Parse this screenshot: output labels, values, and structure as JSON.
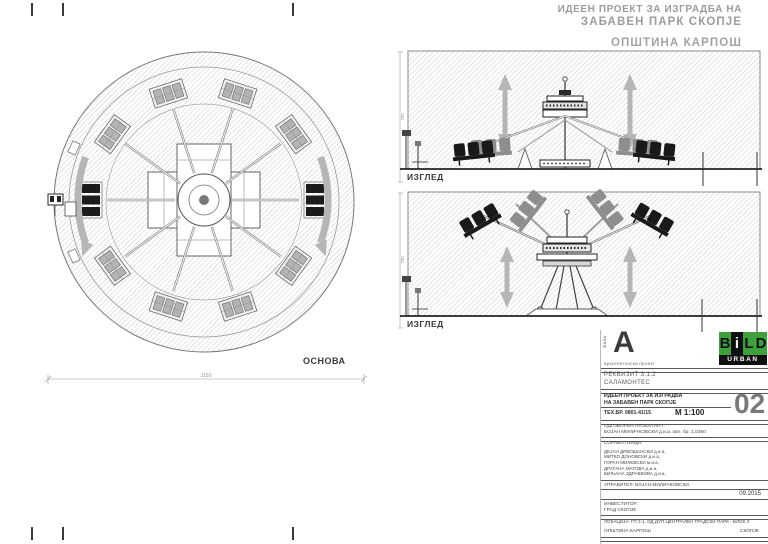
{
  "header": {
    "line1": "ИДЕЕН ПРОЕКТ ЗА ИЗГРАДБА НА",
    "line2": "ЗАБАВЕН ПАРК СКОПЈЕ",
    "line3": "ОПШТИНА КАРПОШ"
  },
  "plan": {
    "label": "ОСНОВА",
    "dim_width": "1150"
  },
  "elevations": {
    "top_label": "ИЗГЛЕД",
    "bottom_label": "ИЗГЛЕД",
    "dim_top": "700",
    "dim_bottom": "700"
  },
  "title_block": {
    "phase_label": "ФАЗА",
    "phase": "A",
    "phase_sub": "архитектонски проект",
    "logo": {
      "b": "B",
      "i": "i",
      "l": "L",
      "d": "D",
      "name": "URBAN",
      "green": "#3da03b",
      "black": "#101012"
    },
    "item": "РЕКВИЗИТ 3.1.2",
    "item_name": "САЛАМОНТЕС",
    "project_line1": "ИДЕЕН ПРОЕКТ ЗА ИЗГРАДБА",
    "project_line2": "НА ЗАБАВЕН ПАРК СКОПЈЕ",
    "tech_no": "ТЕХ.БР. 0801-41/15",
    "scale": "М  1:100",
    "sheet_no": "02",
    "responsible_label": "ОДГОВОРЕН ПРОЕКТАНТ:",
    "responsible": "БОЈАН МИЛИЧКОВСКИ д.и.а.   овл. бр. 1.0360",
    "collaborators_label": "СОРАБОТНИЦИ:",
    "collaborators": [
      "ДЕЈАН ДРВОШАНСКИ д.и.а,",
      "МИТКО ДОНОВСКИ д.и.а,",
      "ГОРАН МИЛЕВСКИ м.и.а,",
      "ДРАГАНА МАТОВА д.и.а,",
      "БИЉАНА ЗДРАВКОВА д.и.а,"
    ],
    "manager": "УПРАВИТЕЛ: БОЈАН МИЛИЧКОВСКИ",
    "date": "09.2015",
    "investor_label": "ИНВЕСТИТОР:",
    "investor": "ГРАД СКОПЈЕ",
    "location": "ЛОКАЦИЈА: ГП 3.1, ОД ДУП ЦЕНТРАЛЕН ГРАДСКИ ПАРК - БЛОК 3",
    "municipality": "ОПШТИНА КАРПОШ",
    "city": "СКОПЈЕ"
  }
}
